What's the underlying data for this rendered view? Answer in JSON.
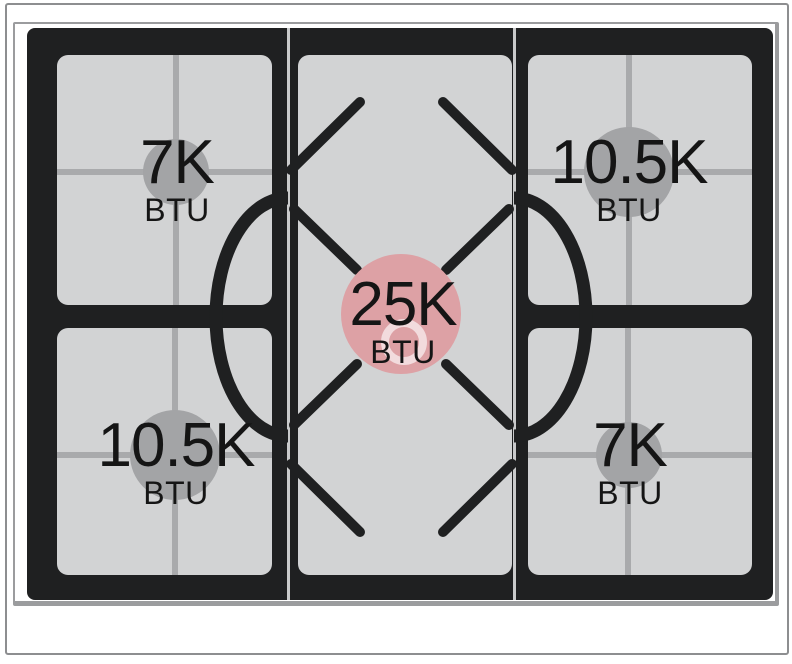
{
  "diagram": {
    "kind": "gas-range-cooktop-btu-diagram",
    "unit_label": "BTU"
  },
  "burners": [
    {
      "id": "top-left",
      "value": "7K",
      "unit": "BTU",
      "size": "small",
      "circle_color": "#a3a4a6"
    },
    {
      "id": "top-right",
      "value": "10.5K",
      "unit": "BTU",
      "size": "medium",
      "circle_color": "#a3a4a6"
    },
    {
      "id": "center",
      "value": "25K",
      "unit": "BTU",
      "size": "large",
      "circle_color": "#dda1a5",
      "highlight": true
    },
    {
      "id": "bottom-left",
      "value": "10.5K",
      "unit": "BTU",
      "size": "medium",
      "circle_color": "#a3a4a6"
    },
    {
      "id": "bottom-right",
      "value": "7K",
      "unit": "BTU",
      "size": "small",
      "circle_color": "#a3a4a6"
    }
  ],
  "colors": {
    "highlight_burner": "#dda1a5",
    "standard_burner": "#a3a4a6",
    "grate_surface": "#d2d3d4",
    "grate_lines": "#a9aaac",
    "cooktop_panel": "#1f2021",
    "frame_line": "#8d8e90",
    "text": "#151515"
  }
}
